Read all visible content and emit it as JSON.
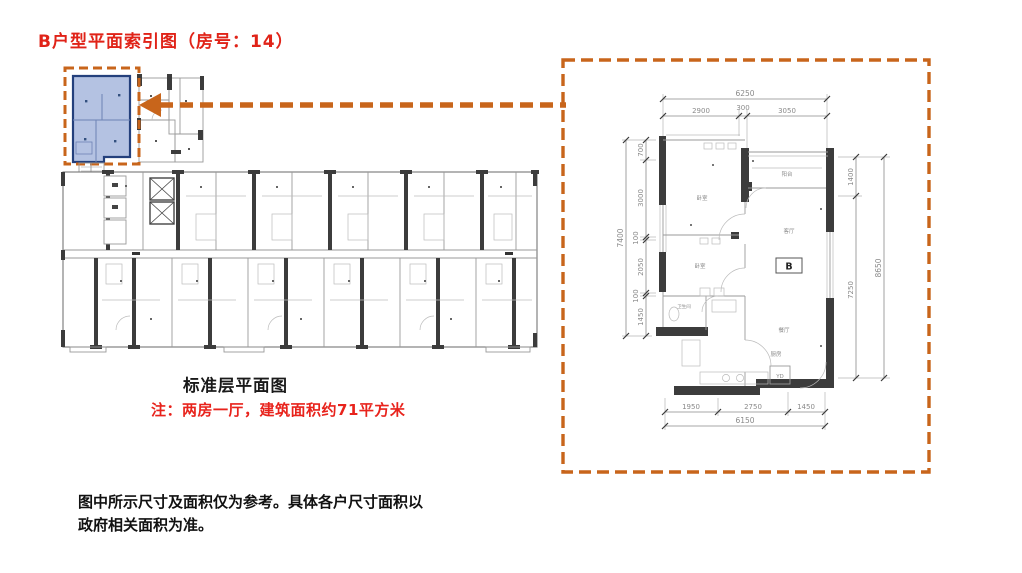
{
  "header": {
    "title": "B户型平面索引图（房号：14）"
  },
  "captions": {
    "plan_caption": "标准层平面图",
    "note": "注：两房一厅，建筑面积约71平方米"
  },
  "footer": {
    "line1": "图中所示尺寸及面积仅为参考。具体各户尺寸面积以",
    "line2": "政府相关面积为准。"
  },
  "colors": {
    "accent_orange": "#c8651b",
    "title_red": "#e02318",
    "note_red": "#e8231c",
    "highlight_fill": "#b4c2e2",
    "highlight_wall": "#24407c",
    "wall_dark": "#3c3c3c"
  },
  "detail": {
    "unit_label": "B",
    "rooms": {
      "balcony": "阳台",
      "bedroom1": "卧室",
      "bedroom2": "卧室",
      "living": "客厅",
      "dining": "餐厅",
      "kitchen": "厨房",
      "bath": "卫生间",
      "laundry": "YD"
    },
    "dims": {
      "top_total": "6250",
      "top": [
        "2900",
        "300",
        "3050"
      ],
      "left_total": "7400",
      "left": [
        "700",
        "3000",
        "100",
        "2050",
        "100",
        "1450"
      ],
      "right_total": "8650",
      "right": [
        "1400",
        "7250"
      ],
      "bottom_total": "6150",
      "bottom": [
        "1950",
        "2750",
        "1450"
      ]
    }
  }
}
